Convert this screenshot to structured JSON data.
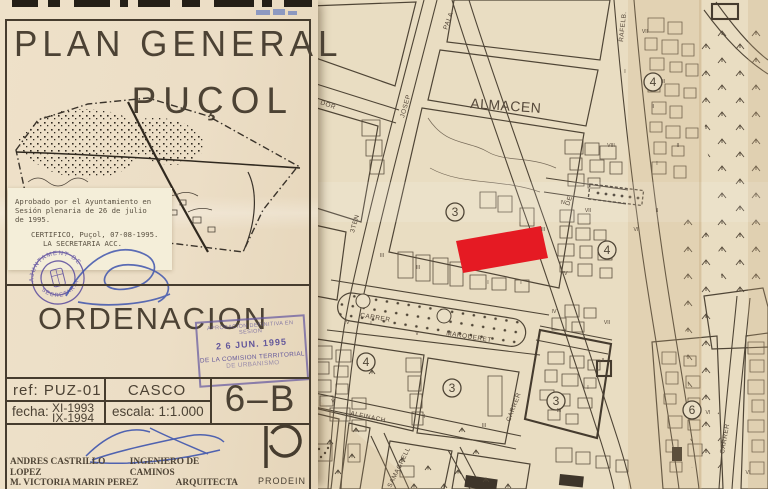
{
  "title_block": {
    "title_line1": "PLAN GENERAL",
    "title_line2": "PUÇOL",
    "approval_note": {
      "lines": [
        "Aprobado por el Ayuntamiento en",
        "Sesión plenaria de 26 de julio",
        "de 1995.",
        "CERTIFICO, Puçol, 07-08-1995.",
        "LA SECRETARIA ACC."
      ]
    },
    "round_stamp": {
      "top_text": "AJUNTAMENT DE",
      "bottom_text": "SECRETARIA"
    },
    "section_title": "ORDENACION",
    "rect_stamp": {
      "lines": [
        "APROBACION DEFINITIVA EN SESION",
        "2 6 JUN. 1995",
        "DE LA COMISION TERRITORIAL",
        "DE URBANISMO"
      ]
    },
    "table": {
      "ref_label": "ref:",
      "ref_value": "PUZ-01",
      "zone": "CASCO",
      "fecha_label": "fecha:",
      "fecha_1": "XI-1993",
      "fecha_2": "IX-1994",
      "escala_label": "escala:",
      "escala_value": "1:1.000",
      "sheet": "6–B"
    },
    "credits": [
      {
        "name": "ANDRES CASTRILLO LOPEZ",
        "role": "INGENIERO DE CAMINOS"
      },
      {
        "name": "M. VICTORIA MARIN PEREZ",
        "role": "ARQUITECTA"
      },
      {
        "name": "FERNANDO BELENGUER MULA",
        "role": "ARQUITECTO"
      }
    ],
    "logo_text": "PRODEIN"
  },
  "map": {
    "highlight_color": "#e51a23",
    "labels": [
      {
        "t": "ALMACEN",
        "x": 470,
        "y": 108,
        "r": 4,
        "s": 14,
        "ls": 5
      },
      {
        "t": "DOR",
        "x": 320,
        "y": 104,
        "r": 20,
        "s": 6.5
      },
      {
        "t": "JOSEP",
        "x": 404,
        "y": 118,
        "r": -74,
        "s": 6.5
      },
      {
        "t": "PALA",
        "x": 447,
        "y": 30,
        "r": -70,
        "s": 6.5
      },
      {
        "t": "3TEN",
        "x": 354,
        "y": 233,
        "r": -74,
        "s": 6.5
      },
      {
        "t": "DE",
        "x": 569,
        "y": 206,
        "r": -70,
        "s": 6.5
      },
      {
        "t": "CARRER",
        "x": 360,
        "y": 317,
        "r": 9,
        "s": 6.5
      },
      {
        "t": "MARQUERET",
        "x": 446,
        "y": 335,
        "r": 9,
        "s": 6.5
      },
      {
        "t": "CARRER",
        "x": 510,
        "y": 422,
        "r": -69,
        "s": 6.5
      },
      {
        "t": "RAFELB.",
        "x": 623,
        "y": 42,
        "r": -84,
        "s": 6.5
      },
      {
        "t": "ALFINACH",
        "x": 350,
        "y": 415,
        "r": 12,
        "s": 6.5
      },
      {
        "t": "SAMAGRELL",
        "x": 391,
        "y": 488,
        "r": -64,
        "s": 6.5
      },
      {
        "t": "CARRER",
        "x": 724,
        "y": 454,
        "r": -80,
        "s": 6.5
      }
    ],
    "zone_numbers": [
      {
        "n": "3",
        "x": 455,
        "y": 212
      },
      {
        "n": "4",
        "x": 653,
        "y": 82
      },
      {
        "n": "4",
        "x": 607,
        "y": 250
      },
      {
        "n": "4",
        "x": 366,
        "y": 362
      },
      {
        "n": "3",
        "x": 452,
        "y": 388
      },
      {
        "n": "3",
        "x": 556,
        "y": 401
      },
      {
        "n": "6",
        "x": 692,
        "y": 410
      }
    ],
    "roman_numerals": [
      [
        "VII",
        645,
        33
      ],
      [
        "I",
        625,
        73
      ],
      [
        "III",
        663,
        83
      ],
      [
        "II",
        653,
        108
      ],
      [
        "VIII",
        611,
        147
      ],
      [
        "II",
        678,
        147
      ],
      [
        "I",
        657,
        165
      ],
      [
        "VII",
        588,
        212
      ],
      [
        "II",
        657,
        212
      ],
      [
        "VI",
        636,
        231
      ],
      [
        "III",
        543,
        231
      ],
      [
        "IV",
        565,
        275
      ],
      [
        "IV",
        554,
        313
      ],
      [
        "VII",
        607,
        324
      ],
      [
        "II",
        603,
        362
      ],
      [
        "I",
        588,
        389
      ],
      [
        "III",
        559,
        412
      ],
      [
        "III",
        382,
        257
      ],
      [
        "III",
        418,
        269
      ],
      [
        "I",
        488,
        284
      ],
      [
        "I",
        521,
        284
      ],
      [
        "IV",
        347,
        324
      ],
      [
        "I",
        371,
        325
      ],
      [
        "V",
        417,
        335
      ],
      [
        "II",
        424,
        418
      ],
      [
        "III",
        484,
        427
      ],
      [
        "V",
        333,
        403
      ],
      [
        "VI",
        708,
        414
      ],
      [
        "VI",
        748,
        474
      ],
      [
        "IV",
        563,
        204
      ]
    ],
    "tree_marks": [
      [
        372,
        372
      ],
      [
        330,
        442
      ],
      [
        352,
        456
      ],
      [
        338,
        472
      ],
      [
        402,
        460
      ],
      [
        428,
        468
      ],
      [
        458,
        472
      ],
      [
        486,
        480
      ],
      [
        414,
        486
      ],
      [
        462,
        430
      ],
      [
        476,
        452
      ],
      [
        356,
        430
      ],
      [
        444,
        486
      ],
      [
        508,
        486
      ]
    ]
  }
}
